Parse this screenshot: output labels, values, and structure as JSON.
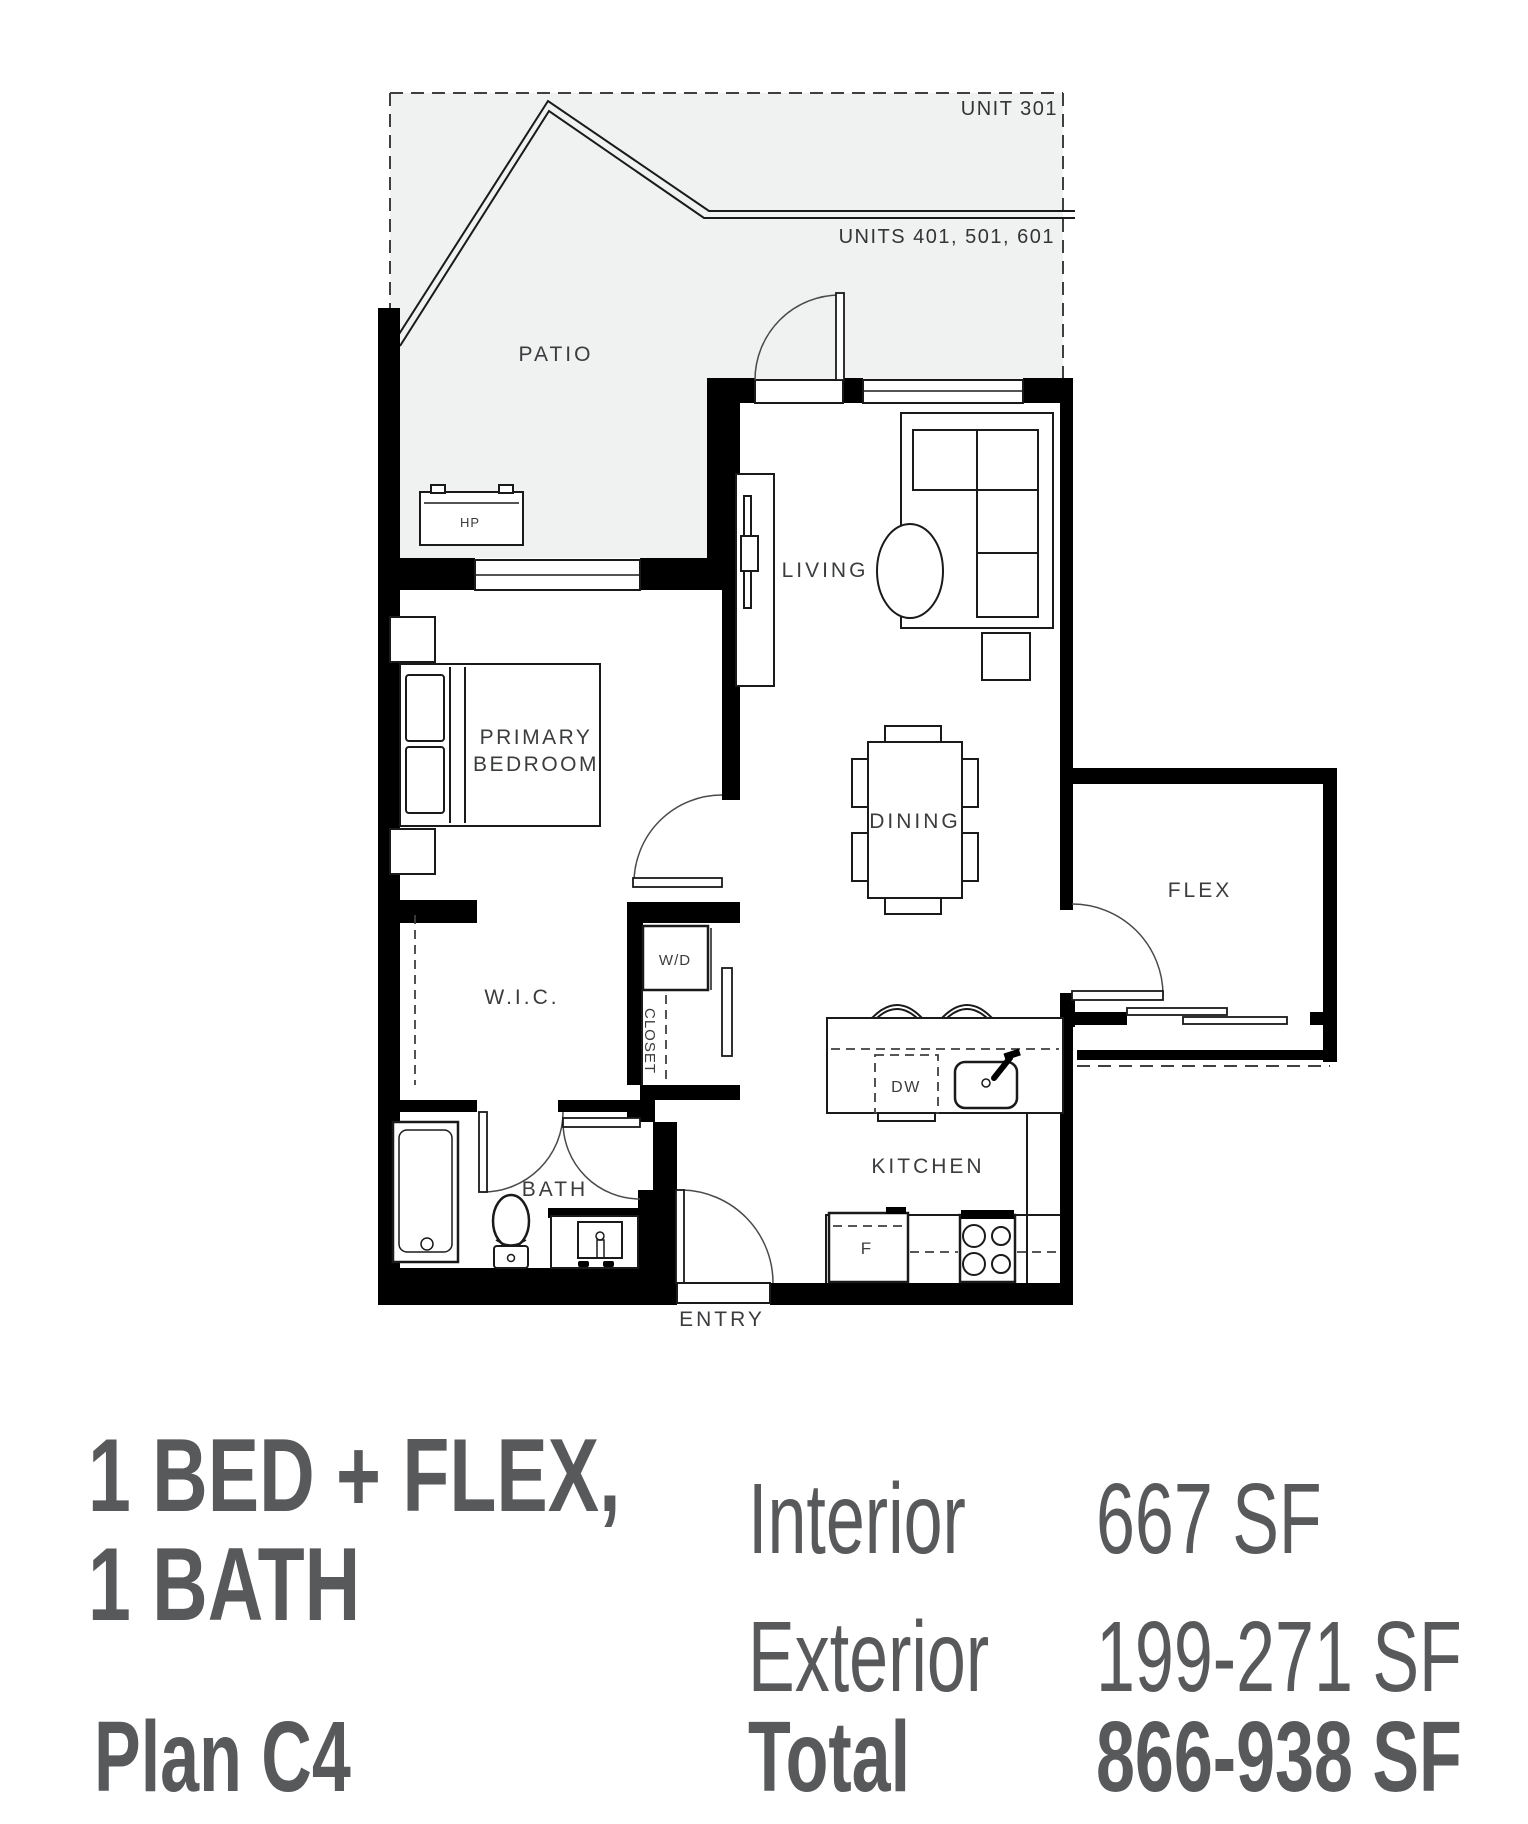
{
  "plan": {
    "unit_labels": {
      "upper": "UNIT 301",
      "lower": "UNITS 401, 501, 601"
    },
    "rooms": {
      "patio": "PATIO",
      "living": "LIVING",
      "primary_bedroom_line1": "PRIMARY",
      "primary_bedroom_line2": "BEDROOM",
      "dining": "DINING",
      "flex": "FLEX",
      "wic": "W.I.C.",
      "kitchen": "KITCHEN",
      "bath": "BATH",
      "entry": "ENTRY"
    },
    "fixtures": {
      "heat_pump": "HP",
      "washer_dryer": "W/D",
      "closet": "CLOSET",
      "dishwasher": "DW",
      "fridge": "F"
    }
  },
  "summary": {
    "title_line1": "1 BED + FLEX,",
    "title_line2": "1 BATH",
    "interior_label": "Interior",
    "interior_value": "667 SF",
    "exterior_label": "Exterior",
    "exterior_value": "199-271 SF",
    "plan_label": "Plan C4",
    "total_label": "Total",
    "total_value": "866-938 SF"
  },
  "colors": {
    "wall": "#000000",
    "patio_fill": "#f0f1f1",
    "summary_text": "#58595b",
    "plan_text": "#3b3c3e"
  }
}
